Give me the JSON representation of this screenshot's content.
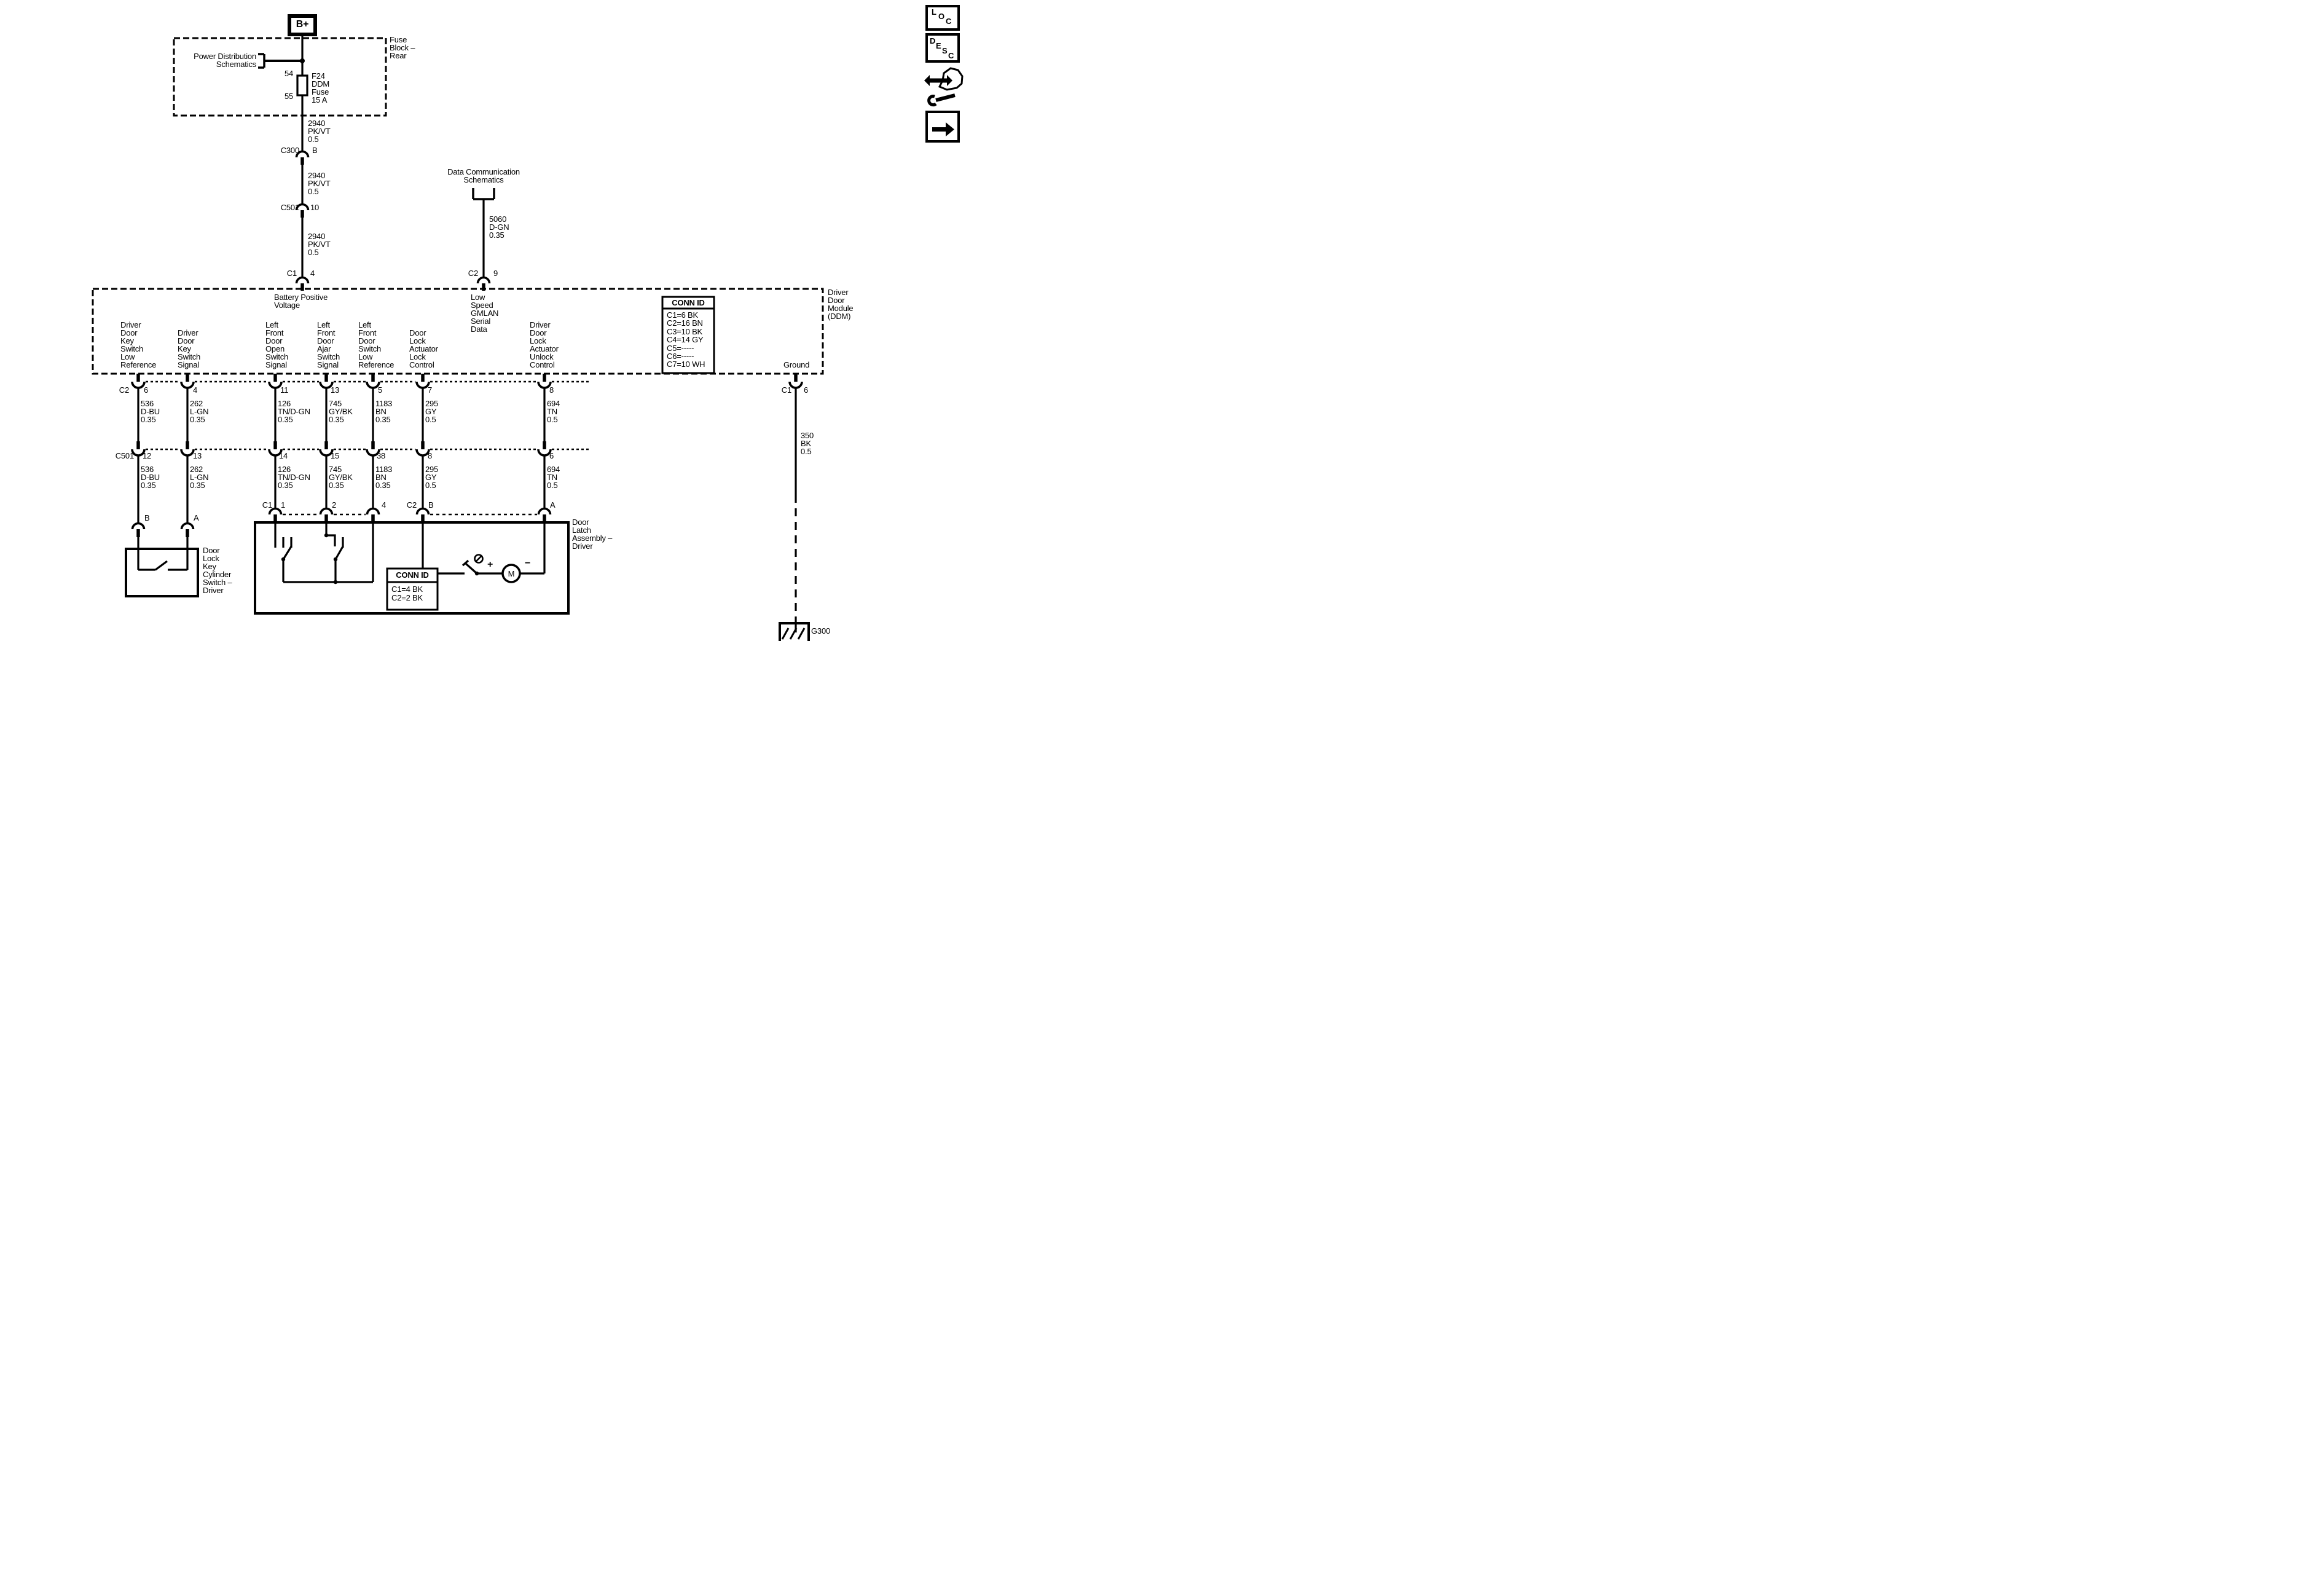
{
  "power_feed": {
    "b_plus": "B+",
    "fuse_block_name": "Fuse\nBlock –\nRear",
    "power_dist_ref": "Power Distribution\nSchematics",
    "fuse_pin_top": "54",
    "fuse_pin_bottom": "55",
    "fuse_name": "F24\nDDM\nFuse\n15 A",
    "wire_seg1": "2940\nPK/VT\n0.5",
    "wire_seg2": "2940\nPK/VT\n0.5",
    "wire_seg3": "2940\nPK/VT\n0.5",
    "c300": {
      "name": "C300",
      "pin": "B"
    },
    "c501": {
      "name": "C501",
      "pin": "10"
    },
    "c1": {
      "name": "C1",
      "pin": "4"
    }
  },
  "data_comm": {
    "ref": "Data Communication\nSchematics",
    "wire": "5060\nD-GN\n0.35",
    "c2": {
      "name": "C2",
      "pin": "9"
    }
  },
  "ddm": {
    "name": "Driver\nDoor\nModule\n(DDM)",
    "battery_input": "Battery Positive\nVoltage",
    "gmlan": "Low\nSpeed\nGMLAN\nSerial\nData",
    "ground": "Ground",
    "functions": [
      "Driver\nDoor\nKey\nSwitch\nLow\nReference",
      "Driver\nDoor\nKey\nSwitch\nSignal",
      "Left\nFront\nDoor\nOpen\nSwitch\nSignal",
      "Left\nFront\nDoor\nAjar\nSwitch\nSignal",
      "Left\nFront\nDoor\nSwitch\nLow\nReference",
      "Door\nLock\nActuator\nLock\nControl",
      "Driver\nDoor\nLock\nActuator\nUnlock\nControl"
    ],
    "conn_id": {
      "title": "CONN ID",
      "rows": "C1=6 BK\nC2=16 BN\nC3=10 BK\nC4=14 GY\nC5=-----\nC6=-----\nC7=10 WH"
    }
  },
  "harness": {
    "row1_connector": "C2",
    "row1_pins": [
      "6",
      "4",
      "11",
      "13",
      "5",
      "7",
      "8"
    ],
    "row2_connector": "C501",
    "row2_pins": [
      "12",
      "13",
      "14",
      "15",
      "38",
      "8",
      "6"
    ],
    "wires": [
      "536\nD-BU\n0.35",
      "262\nL-GN\n0.35",
      "126\nTN/D-GN\n0.35",
      "745\nGY/BK\n0.35",
      "1183\nBN\n0.35",
      "295\nGY\n0.5",
      "694\nTN\n0.5"
    ]
  },
  "key_cylinder": {
    "name": "Door\nLock\nKey\nCylinder\nSwitch –\nDriver",
    "pin_b": "B",
    "pin_a": "A"
  },
  "latch": {
    "name": "Door\nLatch\nAssembly –\nDriver",
    "c1": "C1",
    "c1_pins": [
      "1",
      "2",
      "4"
    ],
    "c2": "C2",
    "c2_pins": [
      "B",
      "A"
    ],
    "motor": "M",
    "plus": "+",
    "minus": "−",
    "conn_id": {
      "title": "CONN ID",
      "rows": "C1=4 BK\nC2=2 BK"
    }
  },
  "ground_circuit": {
    "wire": "350\nBK\n0.5",
    "connector": "C1",
    "pin": "6",
    "ground_id": "G300"
  },
  "toolbar": {
    "loc": [
      "L",
      "O",
      "C"
    ],
    "desc": [
      "D",
      "E",
      "S",
      "C"
    ]
  }
}
